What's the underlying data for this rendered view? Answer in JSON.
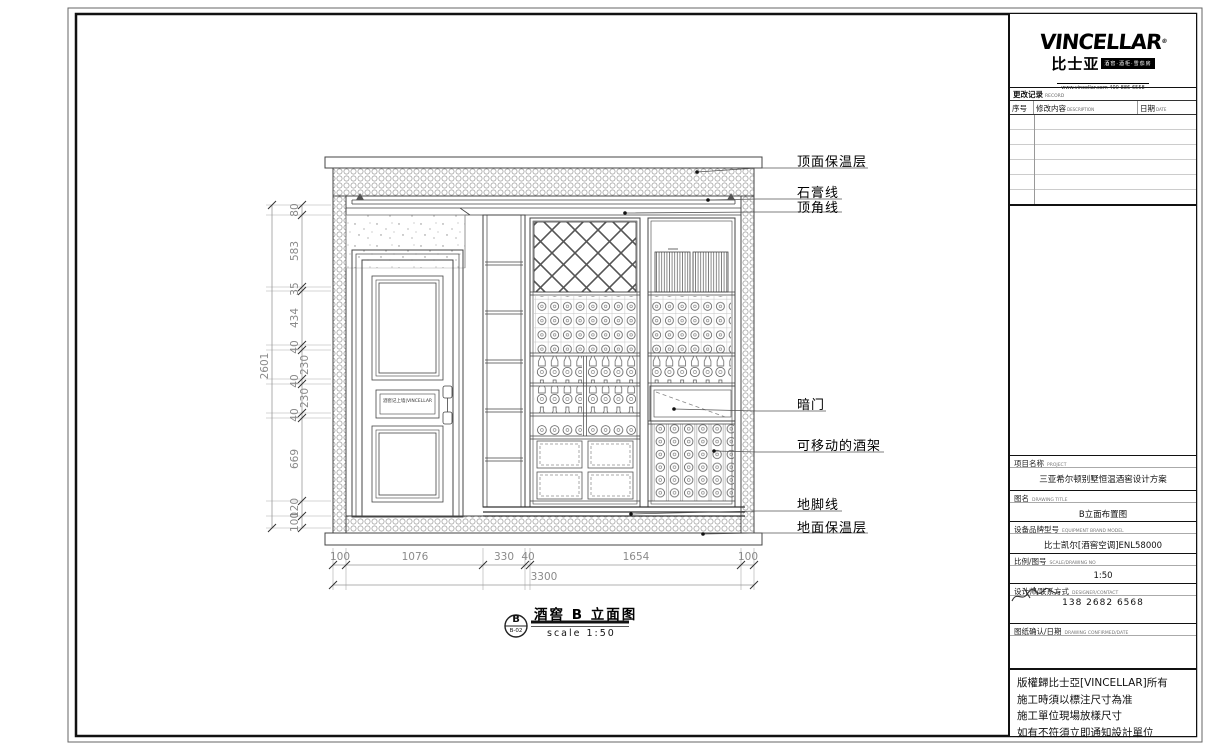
{
  "callouts": [
    "顶面保温层",
    "石膏线",
    "顶角线",
    "暗门",
    "可移动的酒架",
    "地脚线",
    "地面保温层"
  ],
  "dims": {
    "left": [
      "80",
      "583",
      "35",
      "434",
      "40",
      "230",
      "40",
      "230",
      "40",
      "669",
      "120",
      "100"
    ],
    "left_total": "2601",
    "bottom": [
      "100",
      "1076",
      "330",
      "40",
      "1654",
      "100"
    ],
    "bottom_total": "3300"
  },
  "stamp": {
    "bubble_top": "B",
    "bubble_code": "B-02",
    "title": "酒窖 B 立面图",
    "scale_note": "scale 1:50"
  },
  "door_plaque": "酒窖记上墙|VINCELLAR",
  "panel": {
    "logo": {
      "brand": "VINCELLAR",
      "reg": "®",
      "brand_cn": "比士亚",
      "badge": "酒窖·酒柜·雪茄房",
      "url": "www.vincellar.com 400-886-6558"
    },
    "revision": {
      "title": "更改记录",
      "title_en": "RECORD",
      "col_no": "序号",
      "col_no_en": "NO",
      "col_desc": "修改内容",
      "col_desc_en": "DESCRIPTION",
      "col_date": "日期",
      "col_date_en": "DATE"
    },
    "project": {
      "label": "项目名称",
      "label_en": "PROJECT",
      "value": "三亚希尔顿别墅恒温酒窖设计方案"
    },
    "drawing": {
      "label": "图名",
      "label_en": "DRAWING TITLE",
      "value": "B立面布置图"
    },
    "equipment": {
      "label": "设备品牌型号",
      "label_en": "EQUIPMENT BRAND MODEL",
      "value": "比士凯尔[酒窖空调]ENL58000"
    },
    "scale": {
      "label": "比例/图号",
      "label_en": "SCALE/DRAWING NO",
      "value": "1:50"
    },
    "designer": {
      "label": "设计师/联系方式",
      "label_en": "DESIGNER/CONTACT",
      "phone": "138 2682 6568"
    },
    "confirm": {
      "label": "图纸确认/日期",
      "label_en": "DRAWING CONFIRMED/DATE"
    },
    "disclaimer": [
      "版權歸比士亞[VINCELLAR]所有",
      "施工時須以標注尺寸為准",
      "施工單位現場放樣尺寸",
      "如有不符須立即通知設計單位"
    ]
  }
}
